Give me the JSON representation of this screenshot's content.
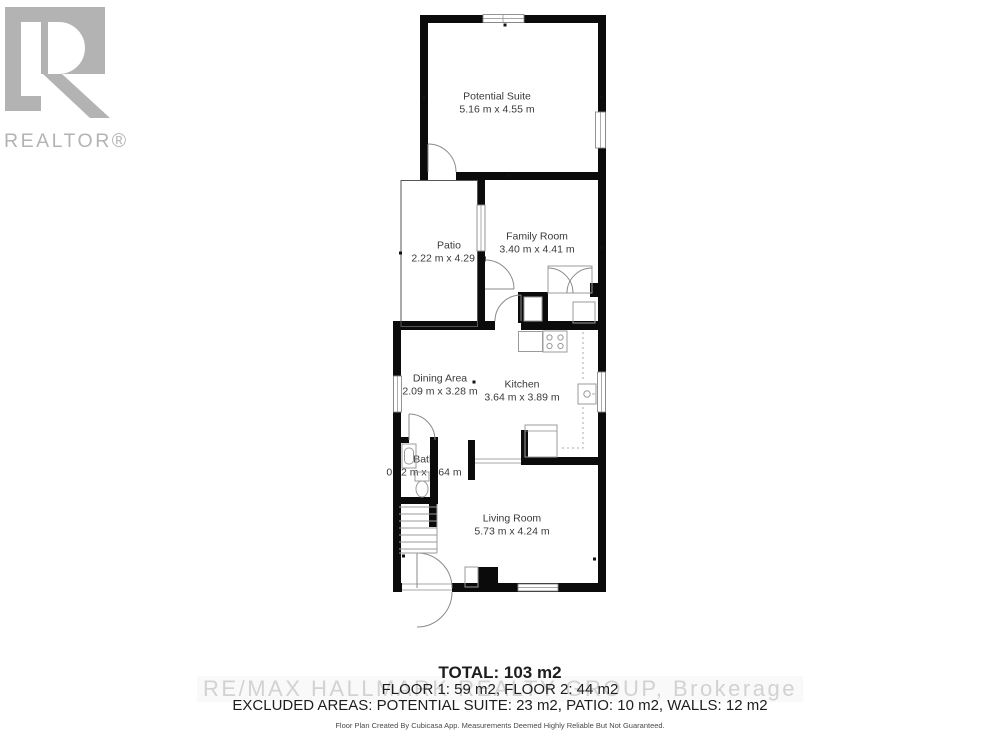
{
  "branding": {
    "realtor_wordmark": "REALTOR®",
    "watermark": "RE/MAX HALLMARK REALTY GROUP, Brokerage"
  },
  "rooms": [
    {
      "name": "Potential Suite",
      "dims": "5.16 m x 4.55 m"
    },
    {
      "name": "Patio",
      "dims": "2.22 m x 4.29 m"
    },
    {
      "name": "Family Room",
      "dims": "3.40 m x 4.41 m"
    },
    {
      "name": "Dining Area",
      "dims": "2.09 m x 3.28 m"
    },
    {
      "name": "Kitchen",
      "dims": "3.64 m x 3.89 m"
    },
    {
      "name": "Bath",
      "dims": "0.92 m x 1.64 m"
    },
    {
      "name": "Living Room",
      "dims": "5.73 m x 4.24 m"
    }
  ],
  "summary": {
    "total": "TOTAL: 103 m2",
    "floors": "FLOOR 1: 59 m2, FLOOR 2: 44 m2",
    "excluded": "EXCLUDED AREAS: POTENTIAL SUITE: 23 m2, PATIO: 10 m2, WALLS: 12 m2"
  },
  "disclaimer": "Floor Plan Created By Cubicasa App. Measurements Deemed Highly Reliable But Not Guaranteed.",
  "colors": {
    "wall": "#0b0b0b",
    "fixture_stroke": "#9b9b9b",
    "label_text": "#3a3a3a",
    "watermark_gray": "#d2d2d2",
    "logo_gray": "#b3b3b3"
  }
}
